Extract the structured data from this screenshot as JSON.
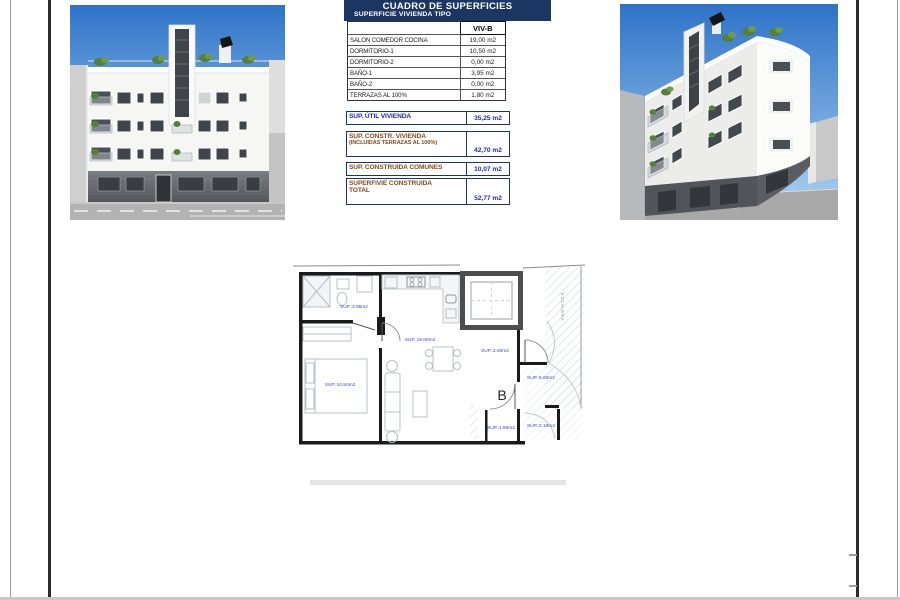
{
  "surface_table": {
    "title": "CUADRO DE SUPERFICIES",
    "subtitle": "SUPERFICIE VIVIENDA TIPO",
    "column_header": "VIV-B",
    "rows": [
      {
        "label": "SALON COMEDOR COCINA",
        "value": "19,00 m2"
      },
      {
        "label": "DORMITORIO-1",
        "value": "10,50 m2"
      },
      {
        "label": "DORMITORIO-2",
        "value": "0,00 m2"
      },
      {
        "label": "BAÑO-1",
        "value": "3,95 m2"
      },
      {
        "label": "BAÑO-2",
        "value": "0,00 m2"
      },
      {
        "label": "TERRAZAS AL 100%",
        "value": "1,80 m2"
      }
    ],
    "summary": [
      {
        "label": "SUP. ÚTIL VIVIENDA",
        "label2": "",
        "value": "35,25 m2"
      },
      {
        "label": "SUP. CONSTR. VIVIENDA",
        "label2": "(INCLUIDAS TERRAZAS AL 100%)",
        "value": "42,70 m2"
      },
      {
        "label": "SUP. CONSTRUIDA COMUNES",
        "label2": "",
        "value": "10,07 m2"
      },
      {
        "label": "SUPERFIVIE CONSTRUIDA",
        "label2": "TOTAL",
        "value": "52,77 m2"
      }
    ]
  },
  "floor_plan": {
    "labels": {
      "bathroom": "SUP.:3.95m2",
      "living_kitchen": "SUP.:19.00m2",
      "bedroom": "SUP.:10.50m2",
      "hall": "SUP.:2.60m2",
      "right_terrace": "SUP.:6.60m2",
      "terrace": "SUP.:1.80m2",
      "corner_terrace": "SUP.:2.10m2",
      "staircase": "ESCALERA",
      "unit_letter": "B"
    }
  },
  "renders": {
    "left_image": "building-front-elevation-3d-render",
    "right_image": "building-corner-perspective-3d-render"
  },
  "colors": {
    "header_navy": "#1c3664",
    "value_blue": "#2228b8",
    "summary_brown": "#8a4a18",
    "plan_label_blue": "#3949c2",
    "sky_top": "#2e72c8",
    "sky_bottom": "#b8dcf4"
  }
}
